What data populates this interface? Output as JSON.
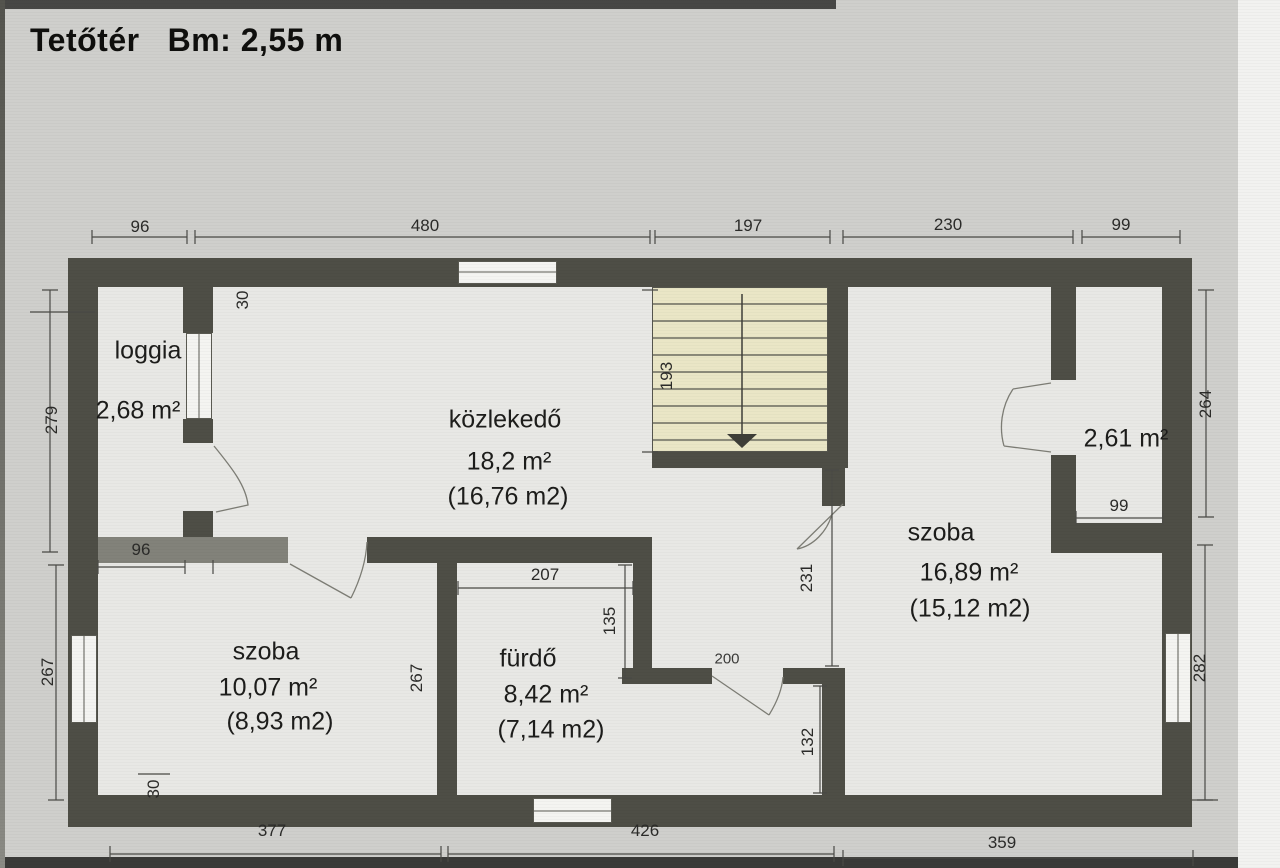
{
  "header": {
    "floor_name": "Tetőtér",
    "ceiling_height": "Bm: 2,55 m"
  },
  "rooms": {
    "loggia": {
      "name": "loggia",
      "area_gross": "2,68 m²"
    },
    "kozlekedo": {
      "name": "közlekedő",
      "area_gross": "18,2 m²",
      "area_net": "(16,76 m2)"
    },
    "szoba_right": {
      "name": "szoba",
      "area_gross": "16,89 m²",
      "area_net": "(15,12 m2)"
    },
    "szoba_left": {
      "name": "szoba",
      "area_gross": "10,07 m²",
      "area_net": "(8,93 m2)"
    },
    "furdo": {
      "name": "fürdő",
      "area_gross": "8,42 m²",
      "area_net": "(7,14 m2)"
    },
    "balcony_right": {
      "area_gross": "2,61 m²"
    }
  },
  "dimensions_cm": {
    "top": [
      "96",
      "480",
      "197",
      "230",
      "99"
    ],
    "bottom": [
      "377",
      "426",
      "359"
    ],
    "left": [
      "279",
      "267"
    ],
    "right": [
      "264",
      "282"
    ],
    "inner": {
      "wall_thickness_top": "30",
      "loggia_width": "96",
      "stair_run": "193",
      "furdo_width": "207",
      "furdo_recess": "135",
      "szoba_left_depth": "267",
      "szoba_right_opening": "231",
      "door_width": "200",
      "lower_passage": "132",
      "wall_thickness_bottom": "30",
      "balcony_right_width": "99"
    }
  }
}
